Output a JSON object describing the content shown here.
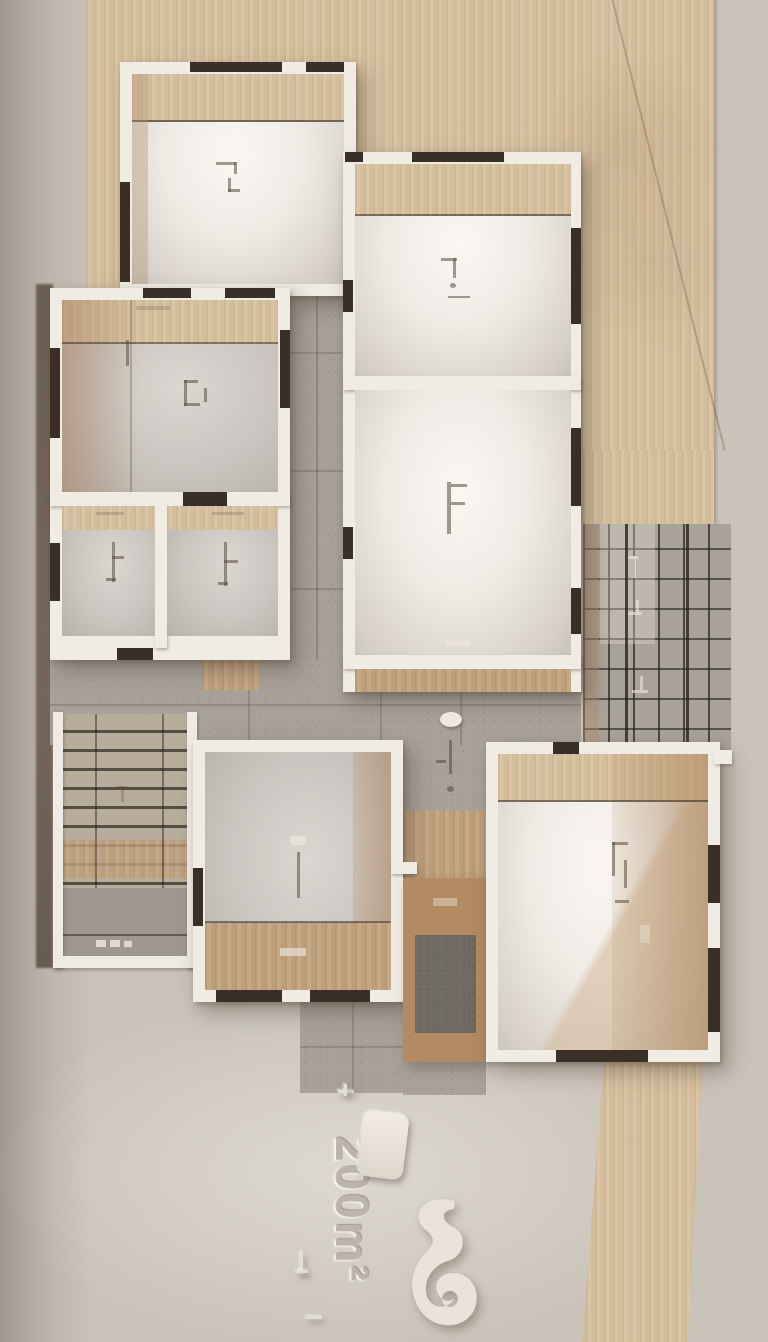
{
  "scene": {
    "description": "photorealistic top-down architectural floor plan render",
    "area_label": "200m²"
  },
  "colors": {
    "background": "#cac3b9",
    "wood_panel": "#d8c1a0",
    "wall_white": "#f0ebe3",
    "opening_dark": "#3a2f26",
    "tile_gray": "#a8a199",
    "floor_bright": "#f7f4ef",
    "floor_gray": "#ccc5c1",
    "wood_floor": "#c2a37f",
    "grid_line": "#49423b",
    "stair_tread": "#b8ac9a",
    "courtyard_gravel": "#6f6a63",
    "emboss_light": "#e4ddd3",
    "emboss_text": "#beb5aa",
    "shadow_band": "#5a4c40"
  }
}
